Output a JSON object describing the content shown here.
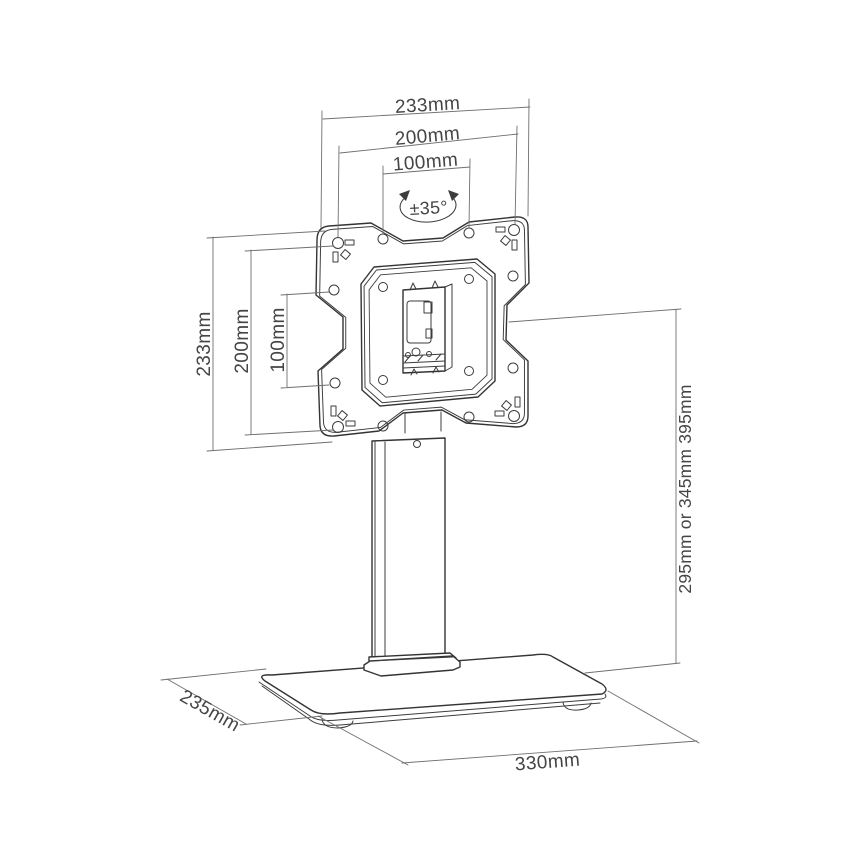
{
  "figure": {
    "type": "technical line drawing",
    "subject": "desktop monitor stand with swivel VESA mounting plate and rectangular base",
    "background_color": "#ffffff",
    "line_color": "#343434",
    "dimension_line_color": "#6f6f6f",
    "text_color": "#454545"
  },
  "dimensions": {
    "top_width": [
      "233mm",
      "200mm",
      "100mm"
    ],
    "left_height": [
      "233mm",
      "200mm",
      "100mm"
    ],
    "rotation": "±35°",
    "right_height": "295mm or 345mm 395mm",
    "base_depth": "235mm",
    "base_width": "330mm"
  }
}
